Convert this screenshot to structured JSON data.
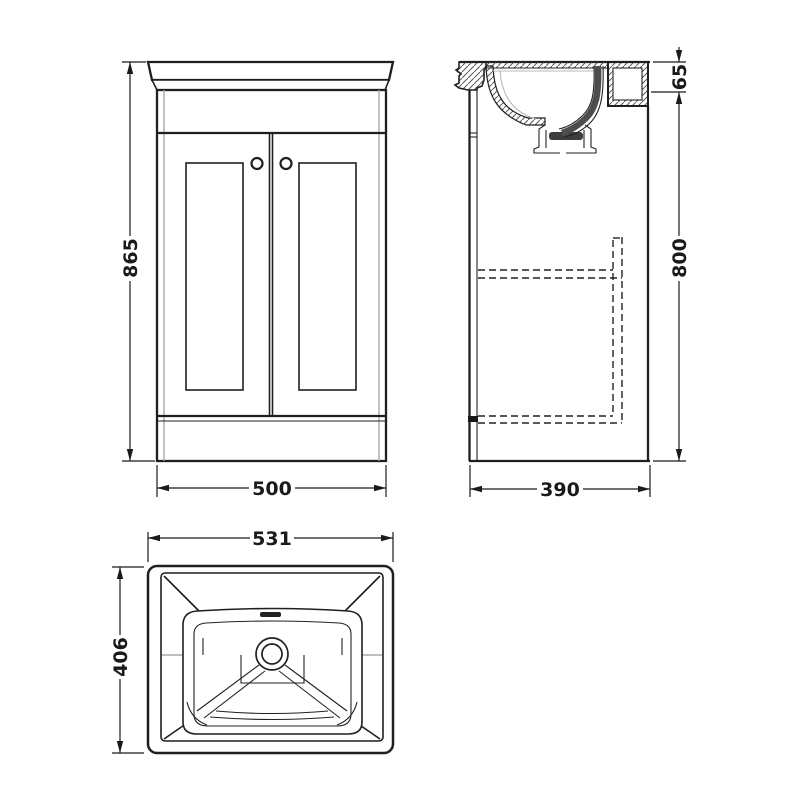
{
  "drawing": {
    "title": "vanity-unit-dimension-drawing",
    "front_view": {
      "height": "865",
      "width": "500"
    },
    "side_view": {
      "rim_height": "65",
      "body_height": "800",
      "depth": "390"
    },
    "plan_view": {
      "width": "531",
      "depth": "406"
    }
  },
  "colors": {
    "line": "#1f1f1f",
    "light_line": "#a8a8a8",
    "background": "#ffffff"
  }
}
